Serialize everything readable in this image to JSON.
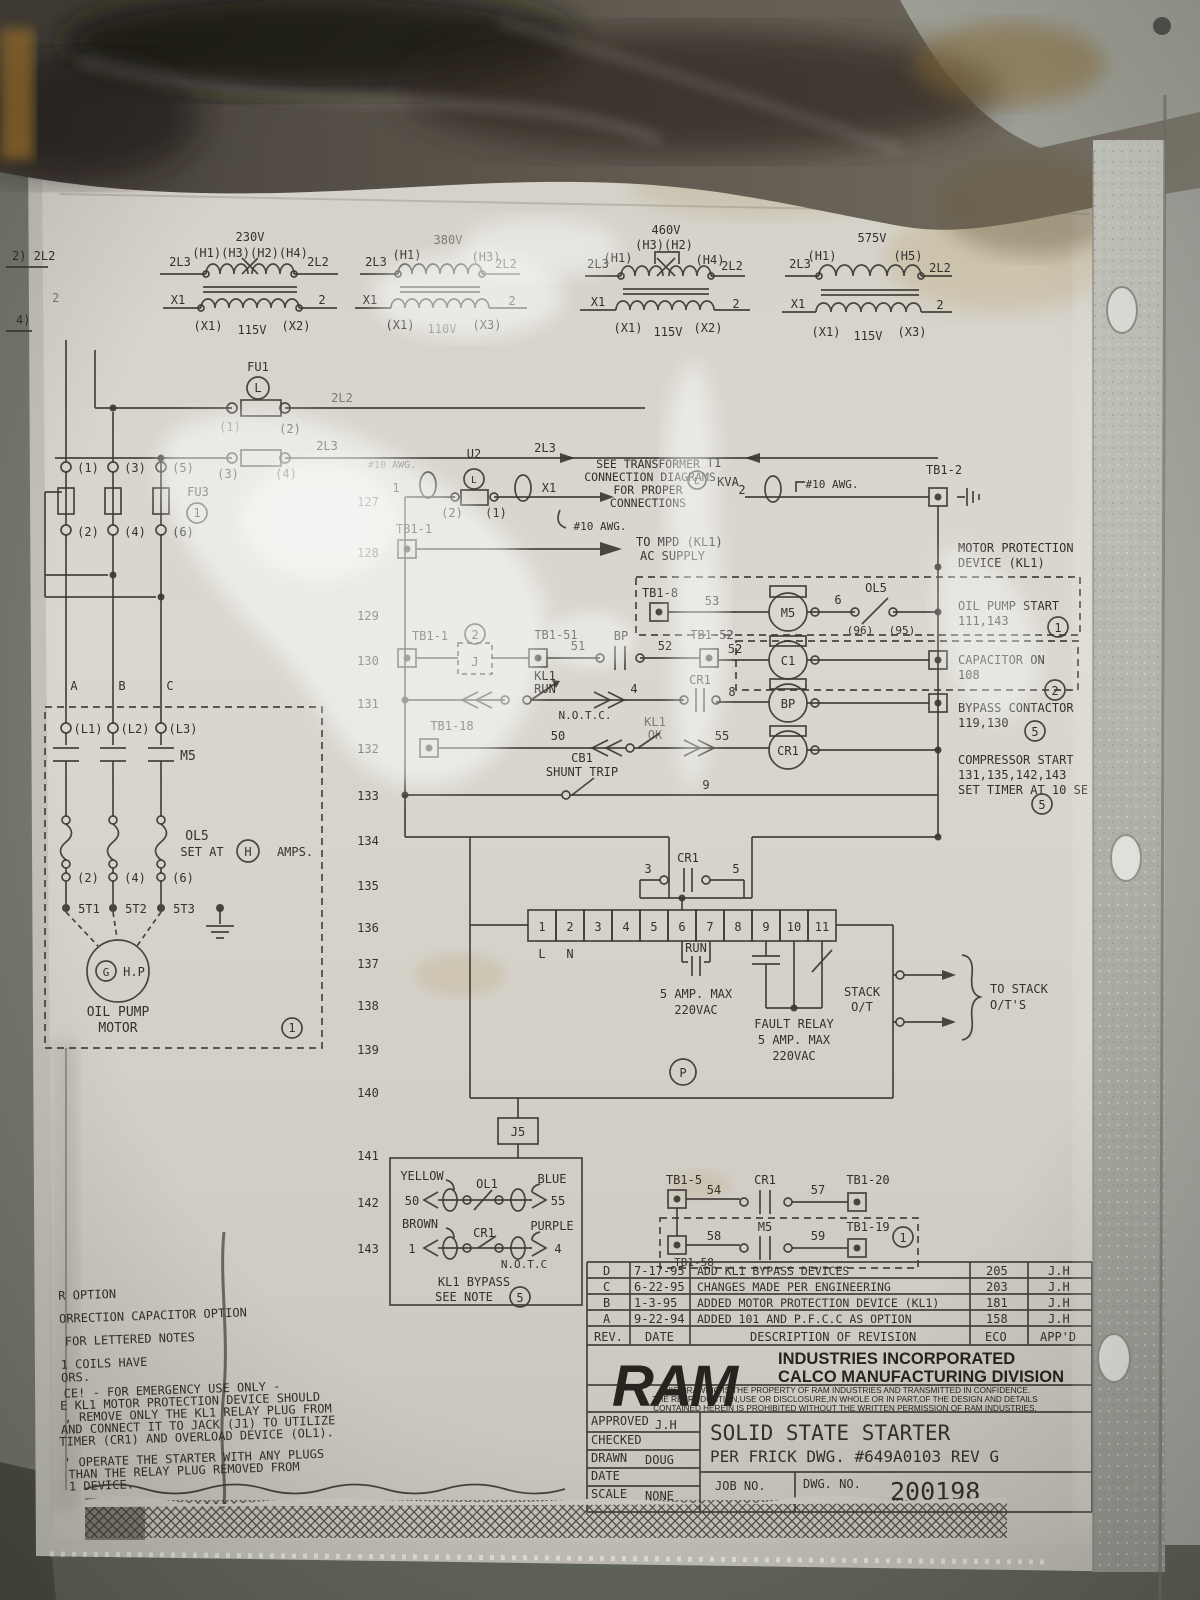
{
  "xf": {
    "t1": {
      "v": "230V",
      "taps": "(H1)(H3)(H2)(H4)",
      "l": "2L3",
      "r": "2L2",
      "x1": "X1",
      "n2": "2",
      "sl": "(X1)",
      "sv": "115V",
      "sr": "(X2)"
    },
    "t2": {
      "v": "380V",
      "hl": "(H1)",
      "hr": "(H3)",
      "l": "2L3",
      "r": "2L2",
      "x1": "X1",
      "n2": "2",
      "sl": "(X1)",
      "sv": "110V",
      "sr": "(X3)"
    },
    "t3": {
      "v": "460V",
      "taps": "(H3)(H2)",
      "hl": "(H1)",
      "hr": "(H4)",
      "l": "2L3",
      "r": "2L2",
      "x1": "X1",
      "n2": "2",
      "sl": "(X1)",
      "sv": "115V",
      "sr": "(X2)"
    },
    "t4": {
      "v": "575V",
      "hl": "(H1)",
      "hr": "(H5)",
      "l": "2L3",
      "r": "2L2",
      "x1": "X1",
      "n2": "2",
      "sl": "(X1)",
      "sv": "115V",
      "sr": "(X3)"
    }
  },
  "edge": {
    "a": "2) 2L2",
    "b": "4)",
    "c": "2"
  },
  "fu1": {
    "name": "FU1",
    "sym": "L",
    "t1": "(1)",
    "t2": "(2)",
    "wire": "2L2"
  },
  "l2l3": {
    "t3": "(3)",
    "t4": "(4)",
    "wire": "2L3",
    "wire2": "2L3",
    "awg": "#10 AWG."
  },
  "fu3": {
    "name": "FU3",
    "note": "1",
    "t1": "(1)",
    "t2": "(2)",
    "t3": "(3)",
    "t4": "(4)",
    "t5": "(5)",
    "t6": "(6)"
  },
  "rows": [
    "127",
    "128",
    "129",
    "130",
    "131",
    "132",
    "133",
    "134",
    "135",
    "136",
    "137",
    "138",
    "139",
    "140",
    "141",
    "142",
    "143"
  ],
  "r127": {
    "n1": "1",
    "u2": "U2",
    "sym": "L",
    "t2": "(2)",
    "t1": "(1)",
    "x1": "X1",
    "awg": "#10 AWG.",
    "note1": "SEE TRANSFORMER",
    "note2": "CONNECTION DIAGRAMS",
    "note3": "FOR PROPER",
    "note4": "CONNECTIONS",
    "t1lbl": "T1",
    "sym2": "L",
    "kva": "KVA",
    "n2": "2",
    "awg2": "#10 AWG.",
    "tb": "TB1-2"
  },
  "r128": {
    "tb": "TB1-1",
    "to1": "TO MPD (KL1)",
    "to2": "AC SUPPLY",
    "mpd1": "MOTOR PROTECTION",
    "mpd2": "DEVICE (KL1)"
  },
  "r129": {
    "tb": "TB1-8",
    "w53": "53",
    "coil": "M5",
    "w6": "6",
    "ol": "OL5",
    "c96": "(96)",
    "c95": "(95)",
    "l1": "OIL PUMP START",
    "l2": "111,143",
    "note": "1"
  },
  "r130": {
    "tb": "TB1-1",
    "note2": "2",
    "j": "J",
    "tb51": "TB1-51",
    "w51": "51",
    "bp": "BP",
    "w52": "52",
    "tb52": "TB1-52",
    "w52b": "52",
    "coil": "C1",
    "l1": "CAPACITOR ON",
    "l2": "108",
    "note": "2"
  },
  "r131": {
    "kl1": "KL1",
    "run": "RUN",
    "notc": "N.O.T.C.",
    "w4": "4",
    "cr1": "CR1",
    "w8": "8",
    "coil": "BP",
    "l1": "BYPASS CONTACTOR",
    "l2": "119,130",
    "note": "5"
  },
  "r132": {
    "tb": "TB1-18",
    "w50": "50",
    "kl1": "KL1",
    "ok": "OK",
    "w55": "55",
    "coil": "CR1",
    "l1": "COMPRESSOR START",
    "l2": "131,135,142,143",
    "l3": "SET TIMER AT 10 SE",
    "note": "5"
  },
  "r133": {
    "cb1": "CB1",
    "shunt": "SHUNT TRIP",
    "w9": "9"
  },
  "sub": {
    "w3": "3",
    "cr1": "CR1",
    "w5": "5"
  },
  "strip": {
    "cells": [
      "1",
      "2",
      "3",
      "4",
      "5",
      "6",
      "7",
      "8",
      "9",
      "10",
      "11"
    ],
    "l": "L",
    "n": "N"
  },
  "run": {
    "lbl": "RUN",
    "a": "5 AMP. MAX",
    "v": "220VAC"
  },
  "fault": {
    "l1": "FAULT RELAY",
    "l2": "5 AMP. MAX",
    "l3": "220VAC"
  },
  "stack": {
    "s1": "STACK",
    "s2": "O/T",
    "t1": "TO STACK",
    "t2": "O/T'S"
  },
  "p": "P",
  "j5": "J5",
  "lp": {
    "a": "A",
    "b": "B",
    "c": "C",
    "l1": "(L1)",
    "l2": "(L2)",
    "l3": "(L3)",
    "m5": "M5",
    "ol": "OL5",
    "set": "SET AT",
    "h": "H",
    "amps": "AMPS.",
    "t2": "(2)",
    "t4": "(4)",
    "t6": "(6)",
    "s1": "5T1",
    "s2": "5T2",
    "s3": "5T3",
    "g": "G",
    "hp": "H.P",
    "m1": "OIL PUMP",
    "m2": "MOTOR",
    "note": "1"
  },
  "bpx": {
    "yellow": "YELLOW",
    "ol1": "OL1",
    "blue": "BLUE",
    "w50": "50",
    "w55": "55",
    "brown": "BROWN",
    "cr1": "CR1",
    "purple": "PURPLE",
    "w1": "1",
    "w4": "4",
    "notc": "N.O.T.C",
    "l1": "KL1 BYPASS",
    "l2": "SEE NOTE",
    "note": "5"
  },
  "br": {
    "tb5": "TB1-5",
    "w54": "54",
    "cr1": "CR1",
    "w57": "57",
    "tb20": "TB1-20",
    "tb58": "TB1-58",
    "w58": "58",
    "m5": "M5",
    "w59": "59",
    "tb19": "TB1-19",
    "note": "1"
  },
  "notes": [
    "R OPTION",
    "ORRECTION CAPACITOR OPTION",
    "FOR LETTERED NOTES",
    "1 COILS HAVE",
    "ORS.",
    "CE! - FOR EMERGENCY USE ONLY -",
    "E KL1 MOTOR PROTECTION DEVICE SHOULD",
    ", REMOVE ONLY THE KL1 RELAY PLUG FROM",
    "AND CONNECT IT TO JACK (J1) TO UTILIZE",
    "TIMER (CR1) AND OVERLOAD DEVICE (OL1).",
    "' OPERATE THE STARTER WITH ANY PLUGS",
    "THAN THE RELAY PLUG REMOVED FROM",
    "1 DEVICE."
  ],
  "rev": {
    "h": {
      "rev": "REV.",
      "date": "DATE",
      "desc": "DESCRIPTION OF REVISION",
      "eco": "ECO",
      "appd": "APP'D"
    },
    "rows": [
      {
        "rev": "D",
        "date": "7-17-95",
        "desc": "ADD KL1 BYPASS DEVICES",
        "eco": "205",
        "appd": "J.H"
      },
      {
        "rev": "C",
        "date": "6-22-95",
        "desc": "CHANGES MADE PER ENGINEERING",
        "eco": "203",
        "appd": "J.H"
      },
      {
        "rev": "B",
        "date": "1-3-95",
        "desc": "ADDED MOTOR PROTECTION DEVICE (KL1)",
        "eco": "181",
        "appd": "J.H"
      },
      {
        "rev": "A",
        "date": "9-22-94",
        "desc": "ADDED 101 AND P.F.C.C AS OPTION",
        "eco": "158",
        "appd": "J.H"
      }
    ]
  },
  "tblock": {
    "logo": "RAM",
    "co1": "INDUSTRIES INCORPORATED",
    "co2": "CALCO MANUFACTURING DIVISION",
    "lg1": "THIS DRAWING IS THE PROPERTY OF RAM INDUSTRIES AND TRANSMITTED IN CONFIDENCE.",
    "lg2": "THE REPRODUCTION,USE OR DISCLOSURE,IN WHOLE OR IN PART,OF THE DESIGN AND DETAILS",
    "lg3": "CONTAINED HEREIN IS PROHIBITED WITHOUT THE WRITTEN PERMISSION OF RAM INDUSTRIES.",
    "approved": "APPROVED",
    "approved_v": "J.H",
    "checked": "CHECKED",
    "drawn": "DRAWN",
    "drawn_v": "DOUG",
    "date": "DATE",
    "scale": "SCALE",
    "scale_v": "NONE",
    "t1": "SOLID STATE STARTER",
    "t2": "PER FRICK DWG. #649A0103 REV G",
    "job": "JOB NO.",
    "dwg": "DWG. NO.",
    "no": "200198"
  }
}
